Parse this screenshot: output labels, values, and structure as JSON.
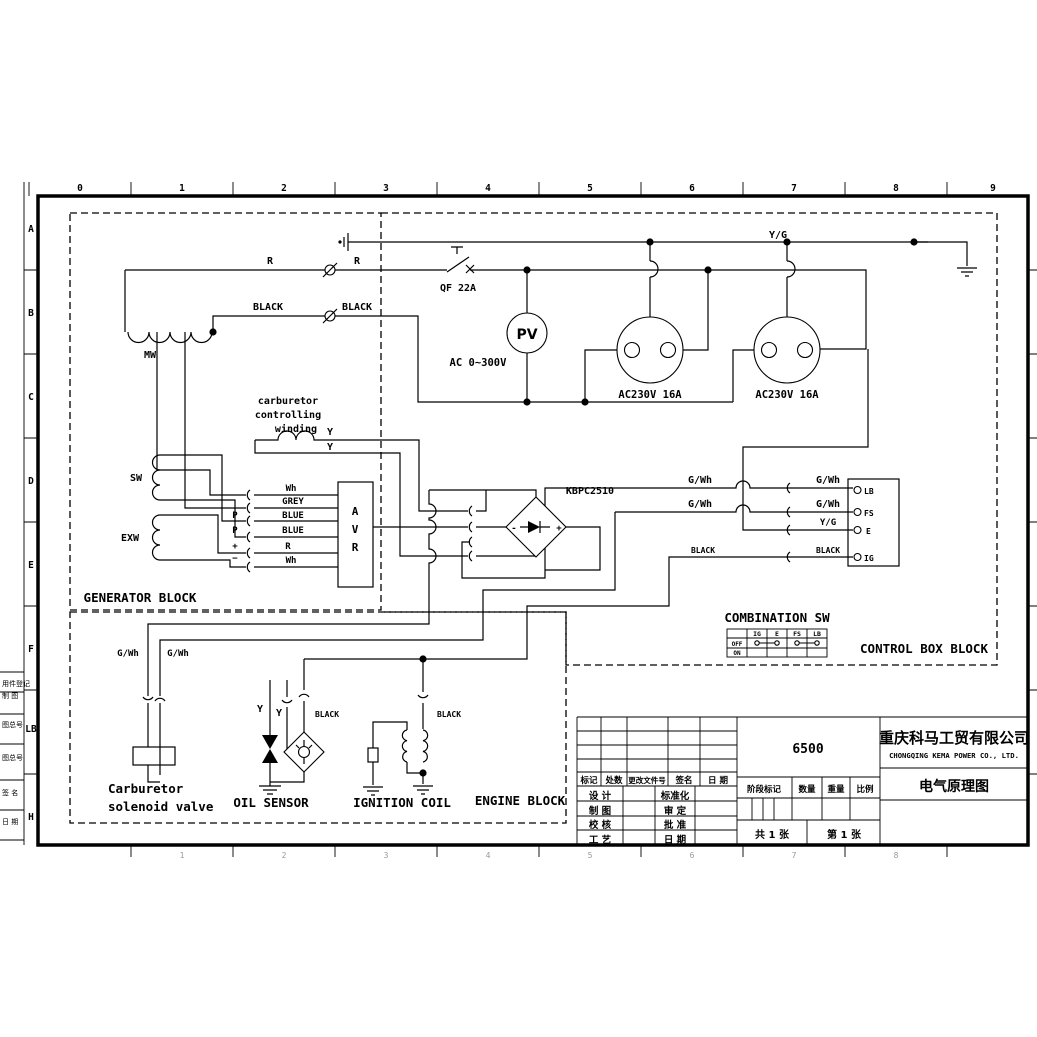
{
  "colors": {
    "ink": "#000000",
    "faint": "#9a9a9a"
  },
  "frame": {
    "top_ruler": [
      {
        "t": "0",
        "x": 80
      },
      {
        "t": "1",
        "x": 182
      },
      {
        "t": "2",
        "x": 284
      },
      {
        "t": "3",
        "x": 386
      },
      {
        "t": "4",
        "x": 488
      },
      {
        "t": "5",
        "x": 590
      },
      {
        "t": "6",
        "x": 692
      },
      {
        "t": "7",
        "x": 794
      },
      {
        "t": "8",
        "x": 896
      },
      {
        "t": "9",
        "x": 993
      }
    ],
    "bottom_ruler": [
      {
        "t": "1",
        "x": 182
      },
      {
        "t": "2",
        "x": 284
      },
      {
        "t": "3",
        "x": 386
      },
      {
        "t": "4",
        "x": 488
      },
      {
        "t": "5",
        "x": 590
      },
      {
        "t": "6",
        "x": 692
      },
      {
        "t": "7",
        "x": 794
      },
      {
        "t": "8",
        "x": 896
      }
    ],
    "left_ruler": [
      {
        "t": "A",
        "y": 232
      },
      {
        "t": "B",
        "y": 316
      },
      {
        "t": "C",
        "y": 400
      },
      {
        "t": "D",
        "y": 484
      },
      {
        "t": "E",
        "y": 568
      },
      {
        "t": "F",
        "y": 652
      },
      {
        "t": "LB",
        "y": 732
      },
      {
        "t": "H",
        "y": 820
      }
    ],
    "side_notes": [
      {
        "t": "用件登记",
        "y": 686
      },
      {
        "t": "制 图",
        "y": 698
      },
      {
        "t": "图总号",
        "y": 727
      },
      {
        "t": "图总号",
        "y": 760
      },
      {
        "t": "签 名",
        "y": 795
      },
      {
        "t": "日 期",
        "y": 824
      }
    ]
  },
  "texts": [
    {
      "n": "label-yg",
      "t": "Y/G",
      "x": 778,
      "y": 238,
      "s": 10
    },
    {
      "n": "label-r1",
      "t": "R",
      "x": 270,
      "y": 264,
      "s": 10
    },
    {
      "n": "label-r2",
      "t": "R",
      "x": 357,
      "y": 264,
      "s": 10
    },
    {
      "n": "label-qf",
      "t": "QF 22A",
      "x": 458,
      "y": 291,
      "s": 10
    },
    {
      "n": "label-black1",
      "t": "BLACK",
      "x": 268,
      "y": 310,
      "s": 10
    },
    {
      "n": "label-black2",
      "t": "BLACK",
      "x": 357,
      "y": 310,
      "s": 10
    },
    {
      "n": "label-mw",
      "t": "MW",
      "x": 150,
      "y": 358,
      "s": 10
    },
    {
      "n": "label-pv",
      "t": "PV",
      "x": 527,
      "y": 339,
      "s": 14,
      "f": "cn"
    },
    {
      "n": "label-ac-range",
      "t": "AC 0~300V",
      "x": 478,
      "y": 366,
      "s": 10.5
    },
    {
      "n": "label-socket1",
      "t": "AC230V 16A",
      "x": 650,
      "y": 398,
      "s": 10.5
    },
    {
      "n": "label-socket2",
      "t": "AC230V 16A",
      "x": 787,
      "y": 398,
      "s": 10.5
    },
    {
      "n": "label-carb-1",
      "t": "carburetor",
      "x": 288,
      "y": 404,
      "s": 10
    },
    {
      "n": "label-carb-2",
      "t": "controlling",
      "x": 288,
      "y": 418,
      "s": 10
    },
    {
      "n": "label-carb-3",
      "t": "winding",
      "x": 296,
      "y": 432,
      "s": 10
    },
    {
      "n": "label-y1",
      "t": "Y",
      "x": 330,
      "y": 435,
      "s": 10
    },
    {
      "n": "label-y2",
      "t": "Y",
      "x": 330,
      "y": 450,
      "s": 10
    },
    {
      "n": "label-sw",
      "t": "SW",
      "x": 136,
      "y": 481,
      "s": 10
    },
    {
      "n": "label-exw",
      "t": "EXW",
      "x": 130,
      "y": 541,
      "s": 10
    },
    {
      "n": "label-wh1",
      "t": "Wh",
      "x": 291,
      "y": 491,
      "s": 9
    },
    {
      "n": "label-grey",
      "t": "GREY",
      "x": 293,
      "y": 504,
      "s": 9
    },
    {
      "n": "label-blue1",
      "t": "BLUE",
      "x": 293,
      "y": 518,
      "s": 9
    },
    {
      "n": "label-blue2",
      "t": "BLUE",
      "x": 293,
      "y": 533,
      "s": 9
    },
    {
      "n": "label-r3",
      "t": "R",
      "x": 288,
      "y": 549,
      "s": 9
    },
    {
      "n": "label-wh2",
      "t": "Wh",
      "x": 291,
      "y": 563,
      "s": 9
    },
    {
      "n": "label-p1",
      "t": "P",
      "x": 235,
      "y": 518,
      "s": 9
    },
    {
      "n": "label-p2",
      "t": "P",
      "x": 235,
      "y": 533,
      "s": 9
    },
    {
      "n": "label-plus",
      "t": "+",
      "x": 235,
      "y": 549,
      "s": 9
    },
    {
      "n": "label-minus",
      "t": "−",
      "x": 235,
      "y": 561,
      "s": 9
    },
    {
      "n": "label-avr-a",
      "t": "A",
      "x": 355,
      "y": 515,
      "s": 11
    },
    {
      "n": "label-avr-v",
      "t": "V",
      "x": 355,
      "y": 533,
      "s": 11
    },
    {
      "n": "label-avr-r",
      "t": "R",
      "x": 355,
      "y": 551,
      "s": 11
    },
    {
      "n": "label-kbpc",
      "t": "KBPC2510",
      "x": 590,
      "y": 494,
      "s": 10
    },
    {
      "n": "label-rect-minus",
      "t": "-",
      "x": 514,
      "y": 531,
      "s": 9
    },
    {
      "n": "label-rect-plus",
      "t": "+",
      "x": 559,
      "y": 531,
      "s": 9
    },
    {
      "n": "label-gwh1",
      "t": "G/Wh",
      "x": 700,
      "y": 483,
      "s": 10
    },
    {
      "n": "label-gwh2",
      "t": "G/Wh",
      "x": 828,
      "y": 483,
      "s": 10
    },
    {
      "n": "label-gwh3",
      "t": "G/Wh",
      "x": 700,
      "y": 507,
      "s": 10
    },
    {
      "n": "label-gwh4",
      "t": "G/Wh",
      "x": 828,
      "y": 507,
      "s": 10
    },
    {
      "n": "label-yg2",
      "t": "Y/G",
      "x": 828,
      "y": 525,
      "s": 9
    },
    {
      "n": "label-black3",
      "t": "BLACK",
      "x": 703,
      "y": 553,
      "s": 8
    },
    {
      "n": "label-black4",
      "t": "BLACK",
      "x": 828,
      "y": 553,
      "s": 8
    },
    {
      "n": "label-term-lb",
      "t": "LB",
      "x": 864,
      "y": 494,
      "s": 8,
      "a": "start"
    },
    {
      "n": "label-term-fs",
      "t": "FS",
      "x": 864,
      "y": 516,
      "s": 8,
      "a": "start"
    },
    {
      "n": "label-term-e",
      "t": "E",
      "x": 866,
      "y": 534,
      "s": 8,
      "a": "start"
    },
    {
      "n": "label-term-ig",
      "t": "IG",
      "x": 864,
      "y": 561,
      "s": 8,
      "a": "start"
    },
    {
      "n": "label-combination-sw",
      "t": "COMBINATION SW",
      "x": 777,
      "y": 622,
      "s": 12.5
    },
    {
      "n": "table-h-ig",
      "t": "IG",
      "x": 757,
      "y": 636,
      "s": 6.5
    },
    {
      "n": "table-h-e",
      "t": "E",
      "x": 777,
      "y": 636,
      "s": 6.5
    },
    {
      "n": "table-h-fs",
      "t": "FS",
      "x": 797,
      "y": 636,
      "s": 6.5
    },
    {
      "n": "table-h-lb",
      "t": "LB",
      "x": 817,
      "y": 636,
      "s": 6.5
    },
    {
      "n": "table-r-off",
      "t": "OFF",
      "x": 737,
      "y": 646,
      "s": 6
    },
    {
      "n": "table-r-on",
      "t": "ON",
      "x": 737,
      "y": 655,
      "s": 6
    },
    {
      "n": "label-generator-block",
      "t": "GENERATOR BLOCK",
      "x": 140,
      "y": 602,
      "s": 12.5
    },
    {
      "n": "label-control-box-block",
      "t": "CONTROL BOX BLOCK",
      "x": 924,
      "y": 653,
      "s": 12.5
    },
    {
      "n": "label-engine-block",
      "t": "ENGINE BLOCK",
      "x": 520,
      "y": 805,
      "s": 12.5
    },
    {
      "n": "label-gwh5",
      "t": "G/Wh",
      "x": 128,
      "y": 656,
      "s": 9
    },
    {
      "n": "label-gwh6",
      "t": "G/Wh",
      "x": 178,
      "y": 656,
      "s": 9
    },
    {
      "n": "label-y3",
      "t": "Y",
      "x": 260,
      "y": 712,
      "s": 10
    },
    {
      "n": "label-y4",
      "t": "Y",
      "x": 279,
      "y": 716,
      "s": 10
    },
    {
      "n": "label-black5",
      "t": "BLACK",
      "x": 327,
      "y": 717,
      "s": 8
    },
    {
      "n": "label-black6",
      "t": "BLACK",
      "x": 449,
      "y": 717,
      "s": 8
    },
    {
      "n": "label-solenoid-1",
      "t": "Carburetor",
      "x": 108,
      "y": 793,
      "s": 12.5,
      "a": "start"
    },
    {
      "n": "label-solenoid-2",
      "t": "solenoid valve",
      "x": 108,
      "y": 811,
      "s": 12.5,
      "a": "start"
    },
    {
      "n": "label-oil-sensor",
      "t": "OIL SENSOR",
      "x": 271,
      "y": 807,
      "s": 12.5
    },
    {
      "n": "label-ignition-coil",
      "t": "IGNITION COIL",
      "x": 402,
      "y": 807,
      "s": 12.5
    }
  ],
  "title_block": {
    "company_cn": "重庆科马工贸有限公司",
    "company_en": "CHONGQING KEMA POWER CO., LTD.",
    "drawing_title": "电气原理图",
    "model": "6500",
    "sheet_total": "共 1 张",
    "sheet_no": "第 1 张",
    "cells": [
      {
        "n": "tb-biaoji",
        "t": "标记",
        "x": 589,
        "y": 783,
        "s": 8.5
      },
      {
        "n": "tb-chushu",
        "t": "处数",
        "x": 614,
        "y": 783,
        "s": 8.5
      },
      {
        "n": "tb-genggai",
        "t": "更改文件号",
        "x": 647,
        "y": 783,
        "s": 7.5
      },
      {
        "n": "tb-qianming",
        "t": "签名",
        "x": 684,
        "y": 783,
        "s": 8.5
      },
      {
        "n": "tb-riqi1",
        "t": "日 期",
        "x": 718,
        "y": 783,
        "s": 8.5
      },
      {
        "n": "tb-sheji",
        "t": "设 计",
        "x": 600,
        "y": 799,
        "s": 9.5
      },
      {
        "n": "tb-zhitu",
        "t": "制 图",
        "x": 600,
        "y": 814,
        "s": 9.5
      },
      {
        "n": "tb-jiaohe",
        "t": "校 核",
        "x": 600,
        "y": 828,
        "s": 9.5
      },
      {
        "n": "tb-gongyi",
        "t": "工 艺",
        "x": 600,
        "y": 843,
        "s": 9.5
      },
      {
        "n": "tb-biaozhunhua",
        "t": "标准化",
        "x": 675,
        "y": 799,
        "s": 9.5
      },
      {
        "n": "tb-shending",
        "t": "审 定",
        "x": 675,
        "y": 814,
        "s": 9.5
      },
      {
        "n": "tb-pizhun",
        "t": "批 准",
        "x": 675,
        "y": 828,
        "s": 9.5
      },
      {
        "n": "tb-riqi2",
        "t": "日 期",
        "x": 675,
        "y": 843,
        "s": 9.5
      },
      {
        "n": "tb-jieduan",
        "t": "阶段标记",
        "x": 764,
        "y": 792,
        "s": 8.5
      },
      {
        "n": "tb-shuliang",
        "t": "数量",
        "x": 807,
        "y": 792,
        "s": 8.5
      },
      {
        "n": "tb-zhongliang",
        "t": "重量",
        "x": 836,
        "y": 792,
        "s": 8.5
      },
      {
        "n": "tb-bili",
        "t": "比例",
        "x": 865,
        "y": 792,
        "s": 8.5
      }
    ]
  }
}
